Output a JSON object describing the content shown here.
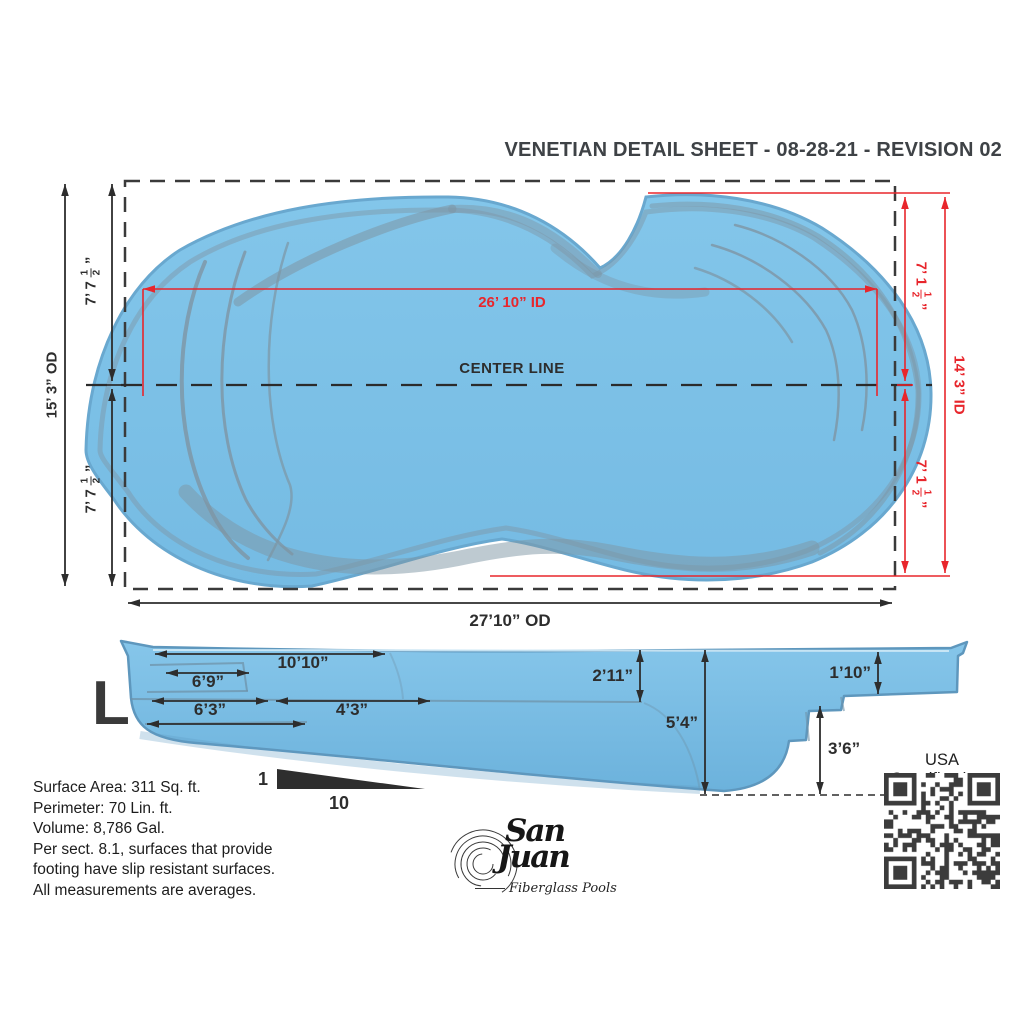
{
  "colors": {
    "pool_blue": "#7dc1e7",
    "pool_blue_dark": "#6cb2dc",
    "rim_blue": "#69a8cf",
    "contour_gray": "#7e95a4",
    "dimension_red": "#e8262c",
    "ink": "#2d2d2d",
    "title_ink": "#3e4246"
  },
  "header": {
    "title": "VENETIAN DETAIL SHEET - 08-28-21 - REVISION 02"
  },
  "top_view": {
    "center_line_label": "CENTER LINE",
    "black_dims": {
      "od_height": "15’ 3” OD",
      "od_width": "27’10” OD",
      "half_top": {
        "prefix": "7’ 7",
        "num": "1",
        "den": "2",
        "suffix": "”"
      },
      "half_bottom": {
        "prefix": "7’ 7",
        "num": "1",
        "den": "2",
        "suffix": "”"
      }
    },
    "red_dims": {
      "id_width": "26’ 10” ID",
      "id_height": "14’ 3” ID",
      "half_top": {
        "prefix": "7’ 1",
        "num": "1",
        "den": "2",
        "suffix": "”"
      },
      "half_bottom": {
        "prefix": "7’ 1",
        "num": "1",
        "den": "2",
        "suffix": "”"
      }
    }
  },
  "side_view": {
    "size_label": "L",
    "dims": {
      "top_length": "10’10”",
      "bench_length": "6’9”",
      "shallow_a": "6’3”",
      "shallow_b": "4’3”",
      "shallow_depth": "2’11”",
      "max_depth": "5’4”",
      "right_bench_depth": "1’10”",
      "deep_step_depth": "3’6”"
    },
    "slope": {
      "rise": "1",
      "run": "10"
    }
  },
  "notes": {
    "lines": [
      "Surface Area:  311 Sq. ft.",
      "Perimeter:  70 Lin. ft.",
      "Volume:  8,786 Gal.",
      "Per sect. 8.1, surfaces that provide",
      "footing have slip resistant surfaces.",
      "All measurements are averages."
    ]
  },
  "logo": {
    "name_line1": "San",
    "name_line2": "Juan",
    "tagline": "Fiberglass Pools"
  },
  "qr": {
    "label": "USA Specifications"
  }
}
